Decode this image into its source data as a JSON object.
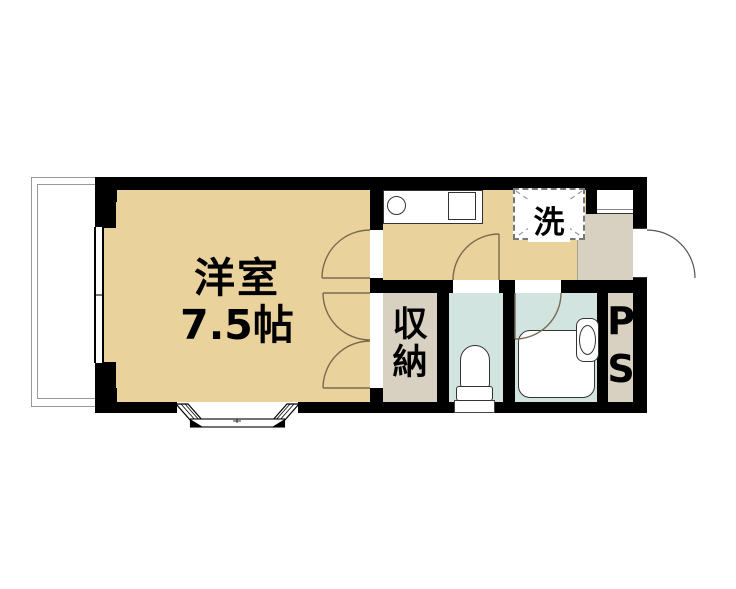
{
  "floorplan": {
    "type": "japanese-apartment-floorplan",
    "rooms": [
      {
        "id": "western-room",
        "name": "洋室",
        "size": "7.5帖"
      },
      {
        "id": "closet",
        "name": "収納",
        "name_chars": [
          "収",
          "納"
        ]
      },
      {
        "id": "laundry-space",
        "name": "洗"
      },
      {
        "id": "pipe-space",
        "name": "PS",
        "name_chars": [
          "P",
          "S"
        ]
      }
    ],
    "colors": {
      "room_floor_tan": "#ead29c",
      "service_floor_grey": "#d8d1c1",
      "wet_area_cyan": "#d2e4e0",
      "wall_black": "#000000",
      "door_arc_brown": "#7a6a4f",
      "balcony_outline_grey": "#999999"
    }
  }
}
